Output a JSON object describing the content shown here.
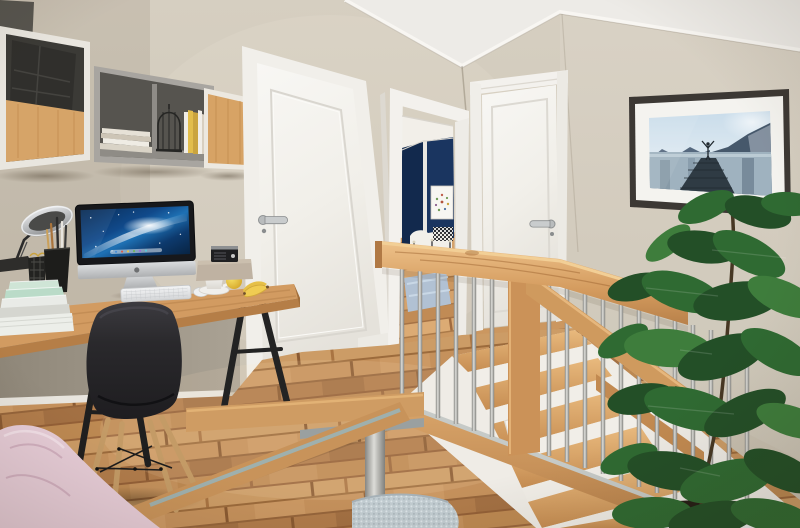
{
  "scene": {
    "type": "interior photograph (3D render style)",
    "room": "home-office landing with open staircase",
    "objects": {
      "wall": "beige textured walls",
      "ceiling": "white ceiling with cove molding",
      "shelf_unit": "wall mounted cube shelf unit",
      "storage_box_dark": "dark grey storage box",
      "felt_organizer": "charcoal felt organizer in white cube",
      "magazines": "stack of magazines on open shelf",
      "birdcage": "black wire decorative cage",
      "books_upright": "upright books with yellow spines",
      "wood_cube": "wood-front wall cube",
      "desk": "wooden trestle desk with black A-frame legs",
      "imac": "silver all-in-one computer, blue galaxy wallpaper",
      "keyboard": "white slim keyboard",
      "mouse": "white mouse",
      "desk_lamp": "chrome articulated desk lamp",
      "pen_cup": "black pen cup with pens and brushes",
      "wire_basket": "black wire basket with clips",
      "book_stack": "stack of mint-green and white books",
      "coffee_cup": "white coffee cup on saucer",
      "radio": "small black retro radio on paper box",
      "apple": "yellow apple",
      "bananas": "pair of bananas",
      "chair": "black shell chair with wooden dowel legs",
      "door_left": "closed white panel door",
      "door_left_handle": "stainless lever handle",
      "doorway": "open doorway into navy-blue bedroom",
      "bedroom_art": "framed botanical wreath print",
      "bedroom_bed": "white bed with black iron frame",
      "bedroom_rug": "light blue rug",
      "door_right": "closed white panel door",
      "door_right_handle": "stainless lever handle",
      "wall_art": "framed photo: person with raised arms on lake jetty",
      "railing": "wooden guard railing with steel balusters",
      "stairs": "wooden staircase descending behind railing",
      "floor": "oak plank flooring",
      "bench": "wooden bench with grey steel frame",
      "pillow": "pale pink pillow",
      "seat_cushion": "knitted light-blue seat cushion",
      "plant": "tall rubber-fig houseplant",
      "plant_pot": "white planter with dark soil"
    }
  },
  "palette": {
    "wall_beige": "#d2cabb",
    "wall_right_beige": "#d7d0c2",
    "ceiling_white": "#edebe7",
    "door_white": "#f4f2ee",
    "bedroom_navy": "#1a3560",
    "rail_wood": "#d9a368",
    "floor_wood": "#c08a54",
    "desk_wood": "#d29b61",
    "leaf_green": "#2f6a32",
    "chair_black": "#28272a",
    "pillow_pink": "#e7cdd8",
    "cushion_blue": "#c2cdd2",
    "steel_silver": "#b9bdbd",
    "screen_blue": "#1b6fb0",
    "accent_yellow": "#e9c840"
  }
}
